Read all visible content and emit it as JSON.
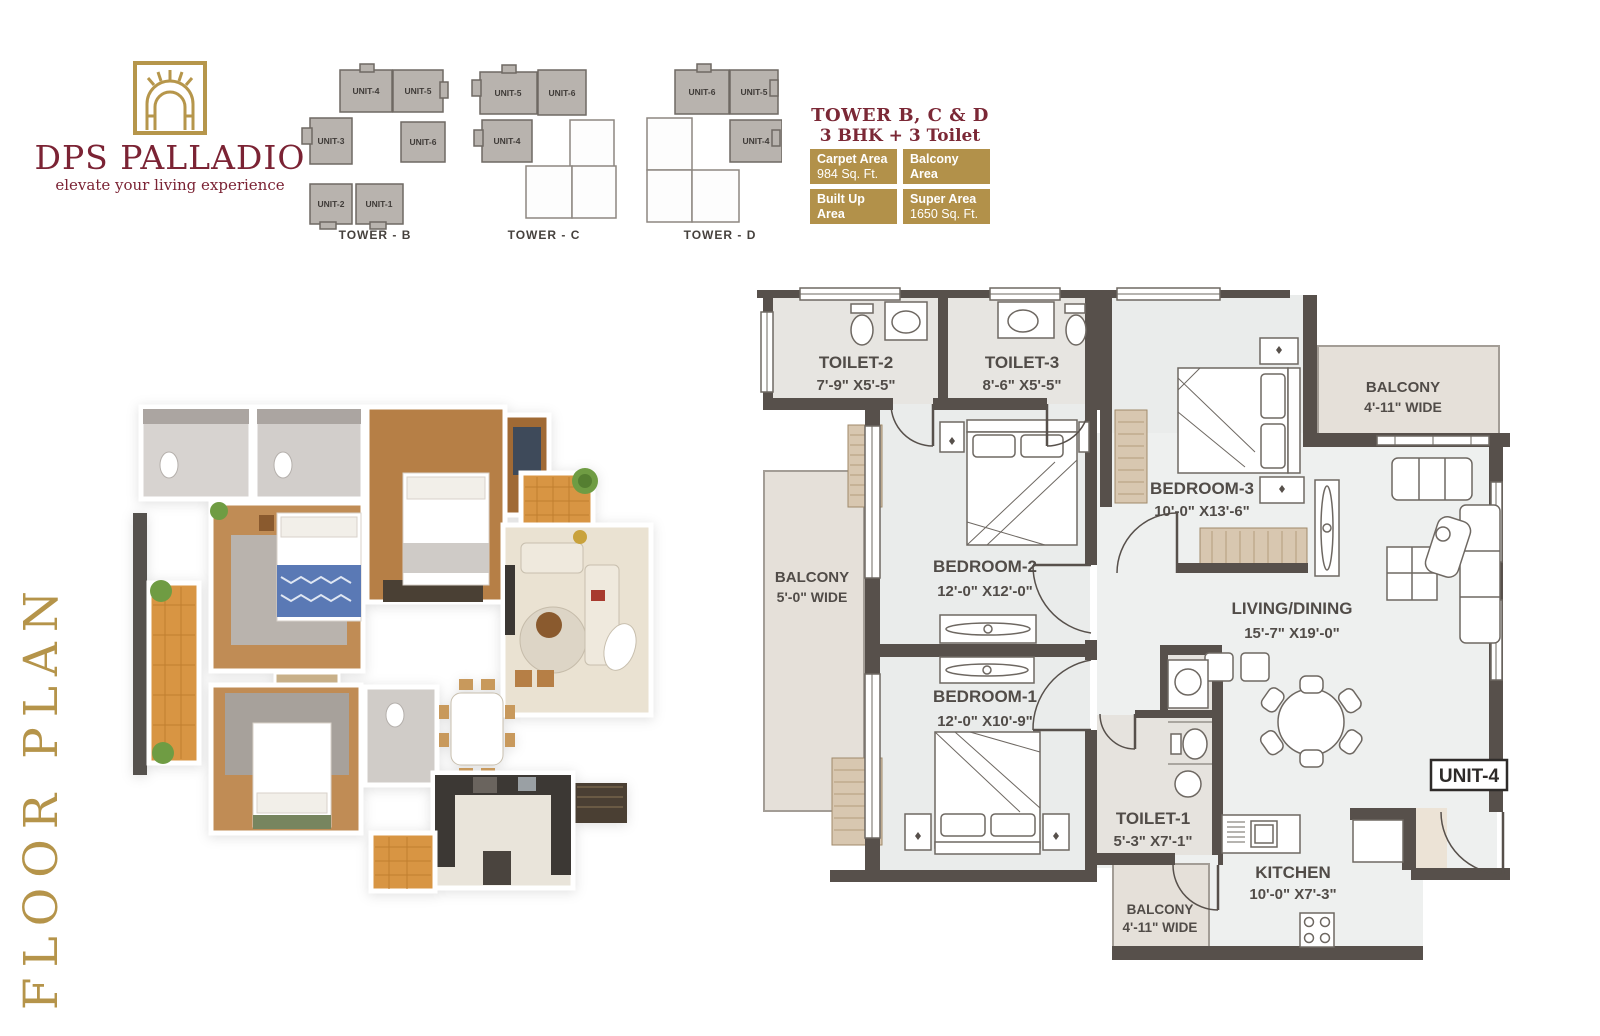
{
  "page": {
    "title": "FLOOR PLAN"
  },
  "brand": {
    "name": "DPS PALLADIO",
    "tagline": "elevate your living experience"
  },
  "key_plans": [
    {
      "name": "TOWER - B",
      "units": [
        {
          "label": "UNIT-4"
        },
        {
          "label": "UNIT-5"
        },
        {
          "label": "UNIT-3"
        },
        {
          "label": "UNIT-6"
        },
        {
          "label": "UNIT-2"
        },
        {
          "label": "UNIT-1"
        }
      ]
    },
    {
      "name": "TOWER - C",
      "units": [
        {
          "label": "UNIT-5"
        },
        {
          "label": "UNIT-6"
        },
        {
          "label": "UNIT-4"
        }
      ]
    },
    {
      "name": "TOWER - D",
      "units": [
        {
          "label": "UNIT-6"
        },
        {
          "label": "UNIT-5"
        },
        {
          "label": "UNIT-4"
        }
      ]
    }
  ],
  "unit_info": {
    "title": "TOWER B, C & D",
    "subtitle": "3 BHK + 3 Toilet",
    "areas": [
      {
        "label": "Carpet Area",
        "value": "984 Sq. Ft."
      },
      {
        "label": "Balcony Area",
        "value": "149 Sq. Ft."
      },
      {
        "label": "Built Up Area",
        "value": "1232 Sq. Ft."
      },
      {
        "label": "Super Area",
        "value": "1650 Sq. Ft."
      }
    ]
  },
  "plan": {
    "unit_label": "UNIT-4",
    "rooms": [
      {
        "name": "TOILET-2",
        "dim": "7'-9\" X5'-5\""
      },
      {
        "name": "TOILET-3",
        "dim": "8'-6\" X5'-5\""
      },
      {
        "name": "BEDROOM-3",
        "dim": "10'-0\" X13'-6\""
      },
      {
        "name": "BEDROOM-2",
        "dim": "12'-0\" X12'-0\""
      },
      {
        "name": "BEDROOM-1",
        "dim": "12'-0\" X10'-9\""
      },
      {
        "name": "LIVING/DINING",
        "dim": "15'-7\" X19'-0\""
      },
      {
        "name": "TOILET-1",
        "dim": "5'-3\" X7'-1\""
      },
      {
        "name": "KITCHEN",
        "dim": "10'-0\" X7'-3\""
      }
    ],
    "balconies": [
      {
        "name": "BALCONY",
        "dim": "4'-11\" WIDE",
        "location": "top-right"
      },
      {
        "name": "BALCONY",
        "dim": "5'-0\" WIDE",
        "location": "left"
      },
      {
        "name": "BALCONY",
        "dim": "4'-11\" WIDE",
        "location": "bottom"
      }
    ]
  },
  "colors": {
    "gold": "#b5944a",
    "maroon": "#7b2334",
    "wall": "#57504b",
    "keyplan_shaded": "#b8b3ae"
  }
}
